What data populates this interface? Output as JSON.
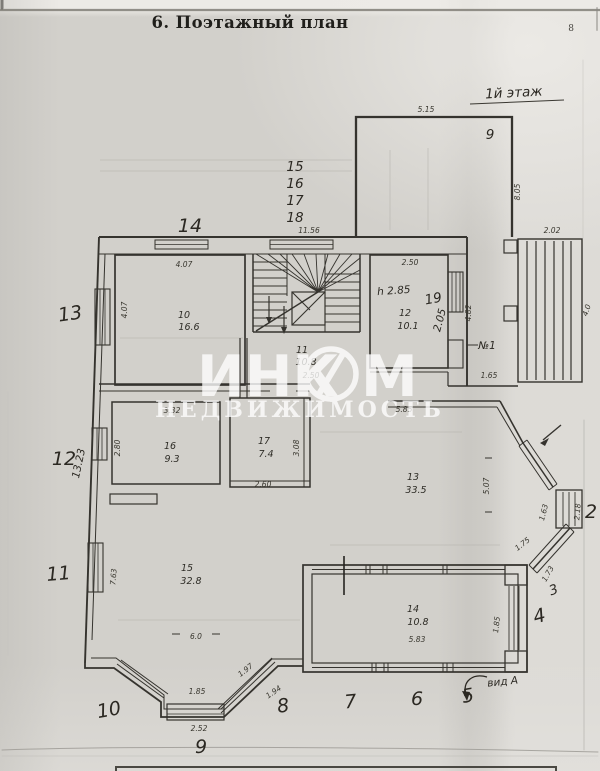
{
  "page": {
    "title": "6. Поэтажный план",
    "number": "8",
    "floor_note": "1й этаж",
    "view_note": "вид А"
  },
  "watermark": {
    "brand": "ИНКОМ",
    "brand_left": "ИНК",
    "brand_right": "М",
    "subtitle": "НЕДВИЖИМОСТЬ"
  },
  "rooms": {
    "r10": {
      "num": "10",
      "area": "16.6"
    },
    "r11": {
      "num": "11",
      "area": "10.8"
    },
    "r12": {
      "num": "12",
      "area": "10.1",
      "height": "h 2.85"
    },
    "r13": {
      "num": "13",
      "area": "33.5"
    },
    "r14": {
      "num": "14",
      "area": "10.8"
    },
    "r15": {
      "num": "15",
      "area": "32.8"
    },
    "r16": {
      "num": "16",
      "area": "9.3"
    },
    "r17": {
      "num": "17",
      "area": "7.4"
    }
  },
  "dims": {
    "terrace_top": "5.15",
    "terrace_right": "8.05",
    "porch_top": "2.02",
    "porch_right": "4.0",
    "top_wall": "11.56",
    "r10_top": "4.07",
    "r10_left": "4.07",
    "r12_top": "2.50",
    "r12_inner": "2.05",
    "r12_right": "4.82",
    "r12_bottom": "1.65",
    "hall_stairs": "2.50",
    "r16_top": "3.32",
    "r16_left": "2.80",
    "left_wall": "13.23",
    "r17_right": "3.08",
    "r17_bottom": "2.60",
    "hall13_top": "5.85",
    "hall13_right": "5.07",
    "bay_win_v": "1.63",
    "bay_win_v2": "2.18",
    "bay_win_d1": "1.75",
    "bay_win_d2": "1.73",
    "r15_left": "7.63",
    "r15_width": "6.0",
    "bay_sw_d1": "1.97",
    "bay_sw_d2": "1.94",
    "bay_s_top": "1.85",
    "bay_s_bottom": "2.52",
    "veranda_bottom": "5.83",
    "veranda_right": "1.85",
    "note_n1": "№1"
  },
  "marks": {
    "m14": "14",
    "m15": "15",
    "m16": "16",
    "m17": "17",
    "m18": "18",
    "m13": "13",
    "m12": "12",
    "m11": "11",
    "m10": "10",
    "m9": "9",
    "m8": "8",
    "m7": "7",
    "m6": "6",
    "m5": "5",
    "m4": "4",
    "m3": "3",
    "m2": "2",
    "m19": "19",
    "m9_terrace": "9"
  }
}
